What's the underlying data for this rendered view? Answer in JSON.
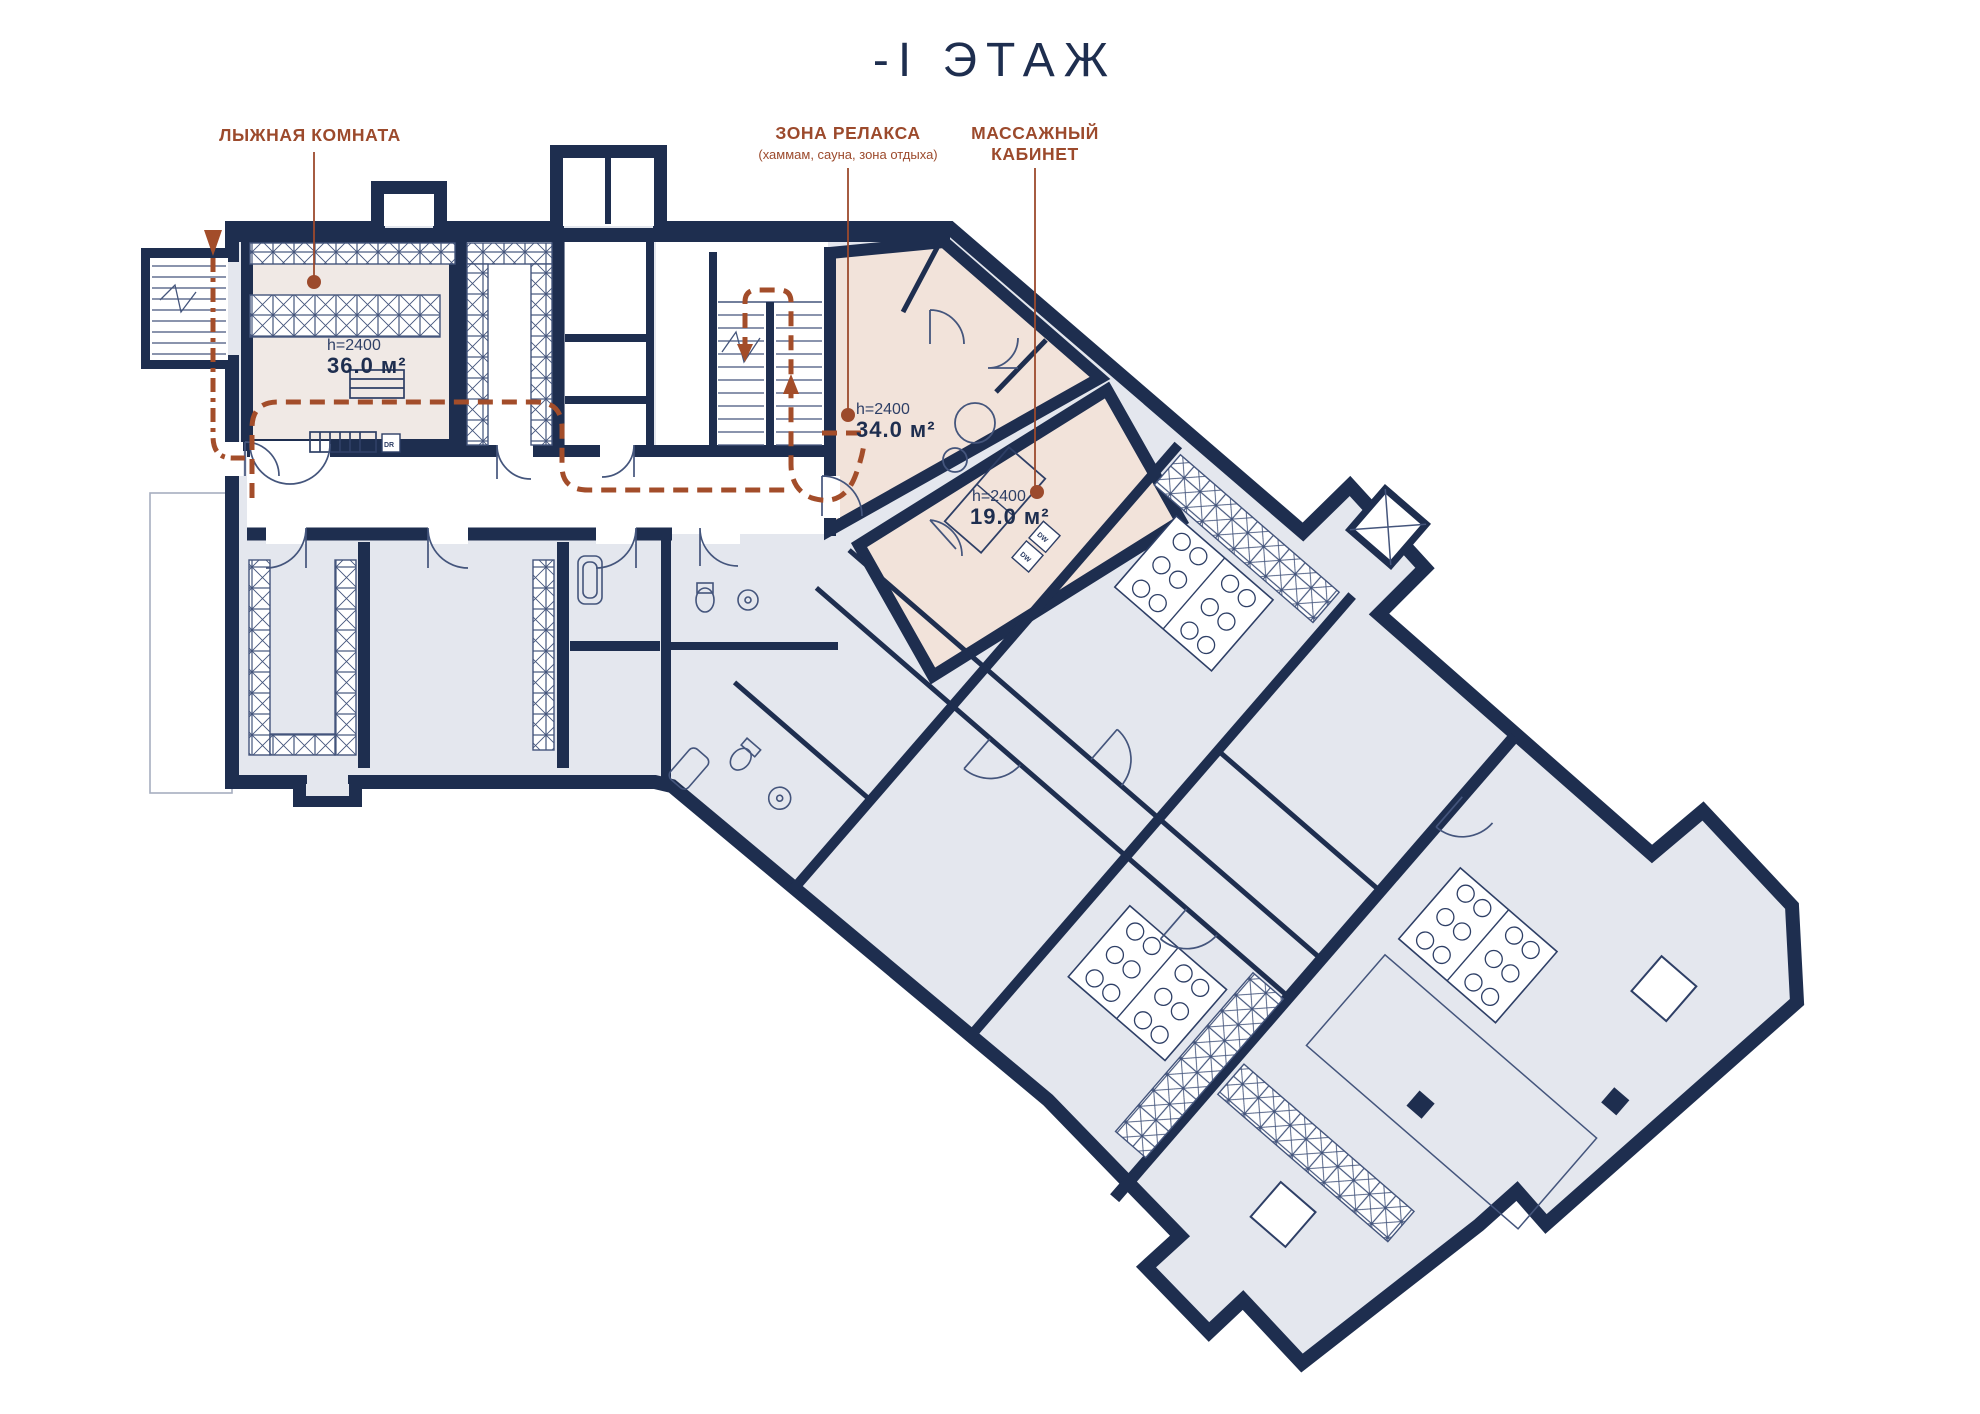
{
  "title": "-I ЭТАЖ",
  "annotations": {
    "ski": {
      "label": "ЛЫЖНАЯ КОМНАТА",
      "height": "h=2400",
      "area": "36.0 м²"
    },
    "relax": {
      "label": "ЗОНА РЕЛАКСА",
      "sublabel": "(хаммам, сауна, зона отдыха)",
      "height": "h=2400",
      "area": "34.0 м²"
    },
    "massage": {
      "label1": "МАССАЖНЫЙ",
      "label2": "КАБИНЕТ",
      "height": "h=2400",
      "area": "19.0 м²"
    }
  },
  "markers": {
    "drain": "DR",
    "dw": "DW"
  },
  "colors": {
    "wall_navy": "#1e2e4f",
    "thin_line": "#44557c",
    "room_gray": "#e4e7ee",
    "ski_pink": "#f0e9e5",
    "highlight_pink": "#f2e3da",
    "annotation_red": "#9c4a2c",
    "route_red": "#a34d2a"
  }
}
